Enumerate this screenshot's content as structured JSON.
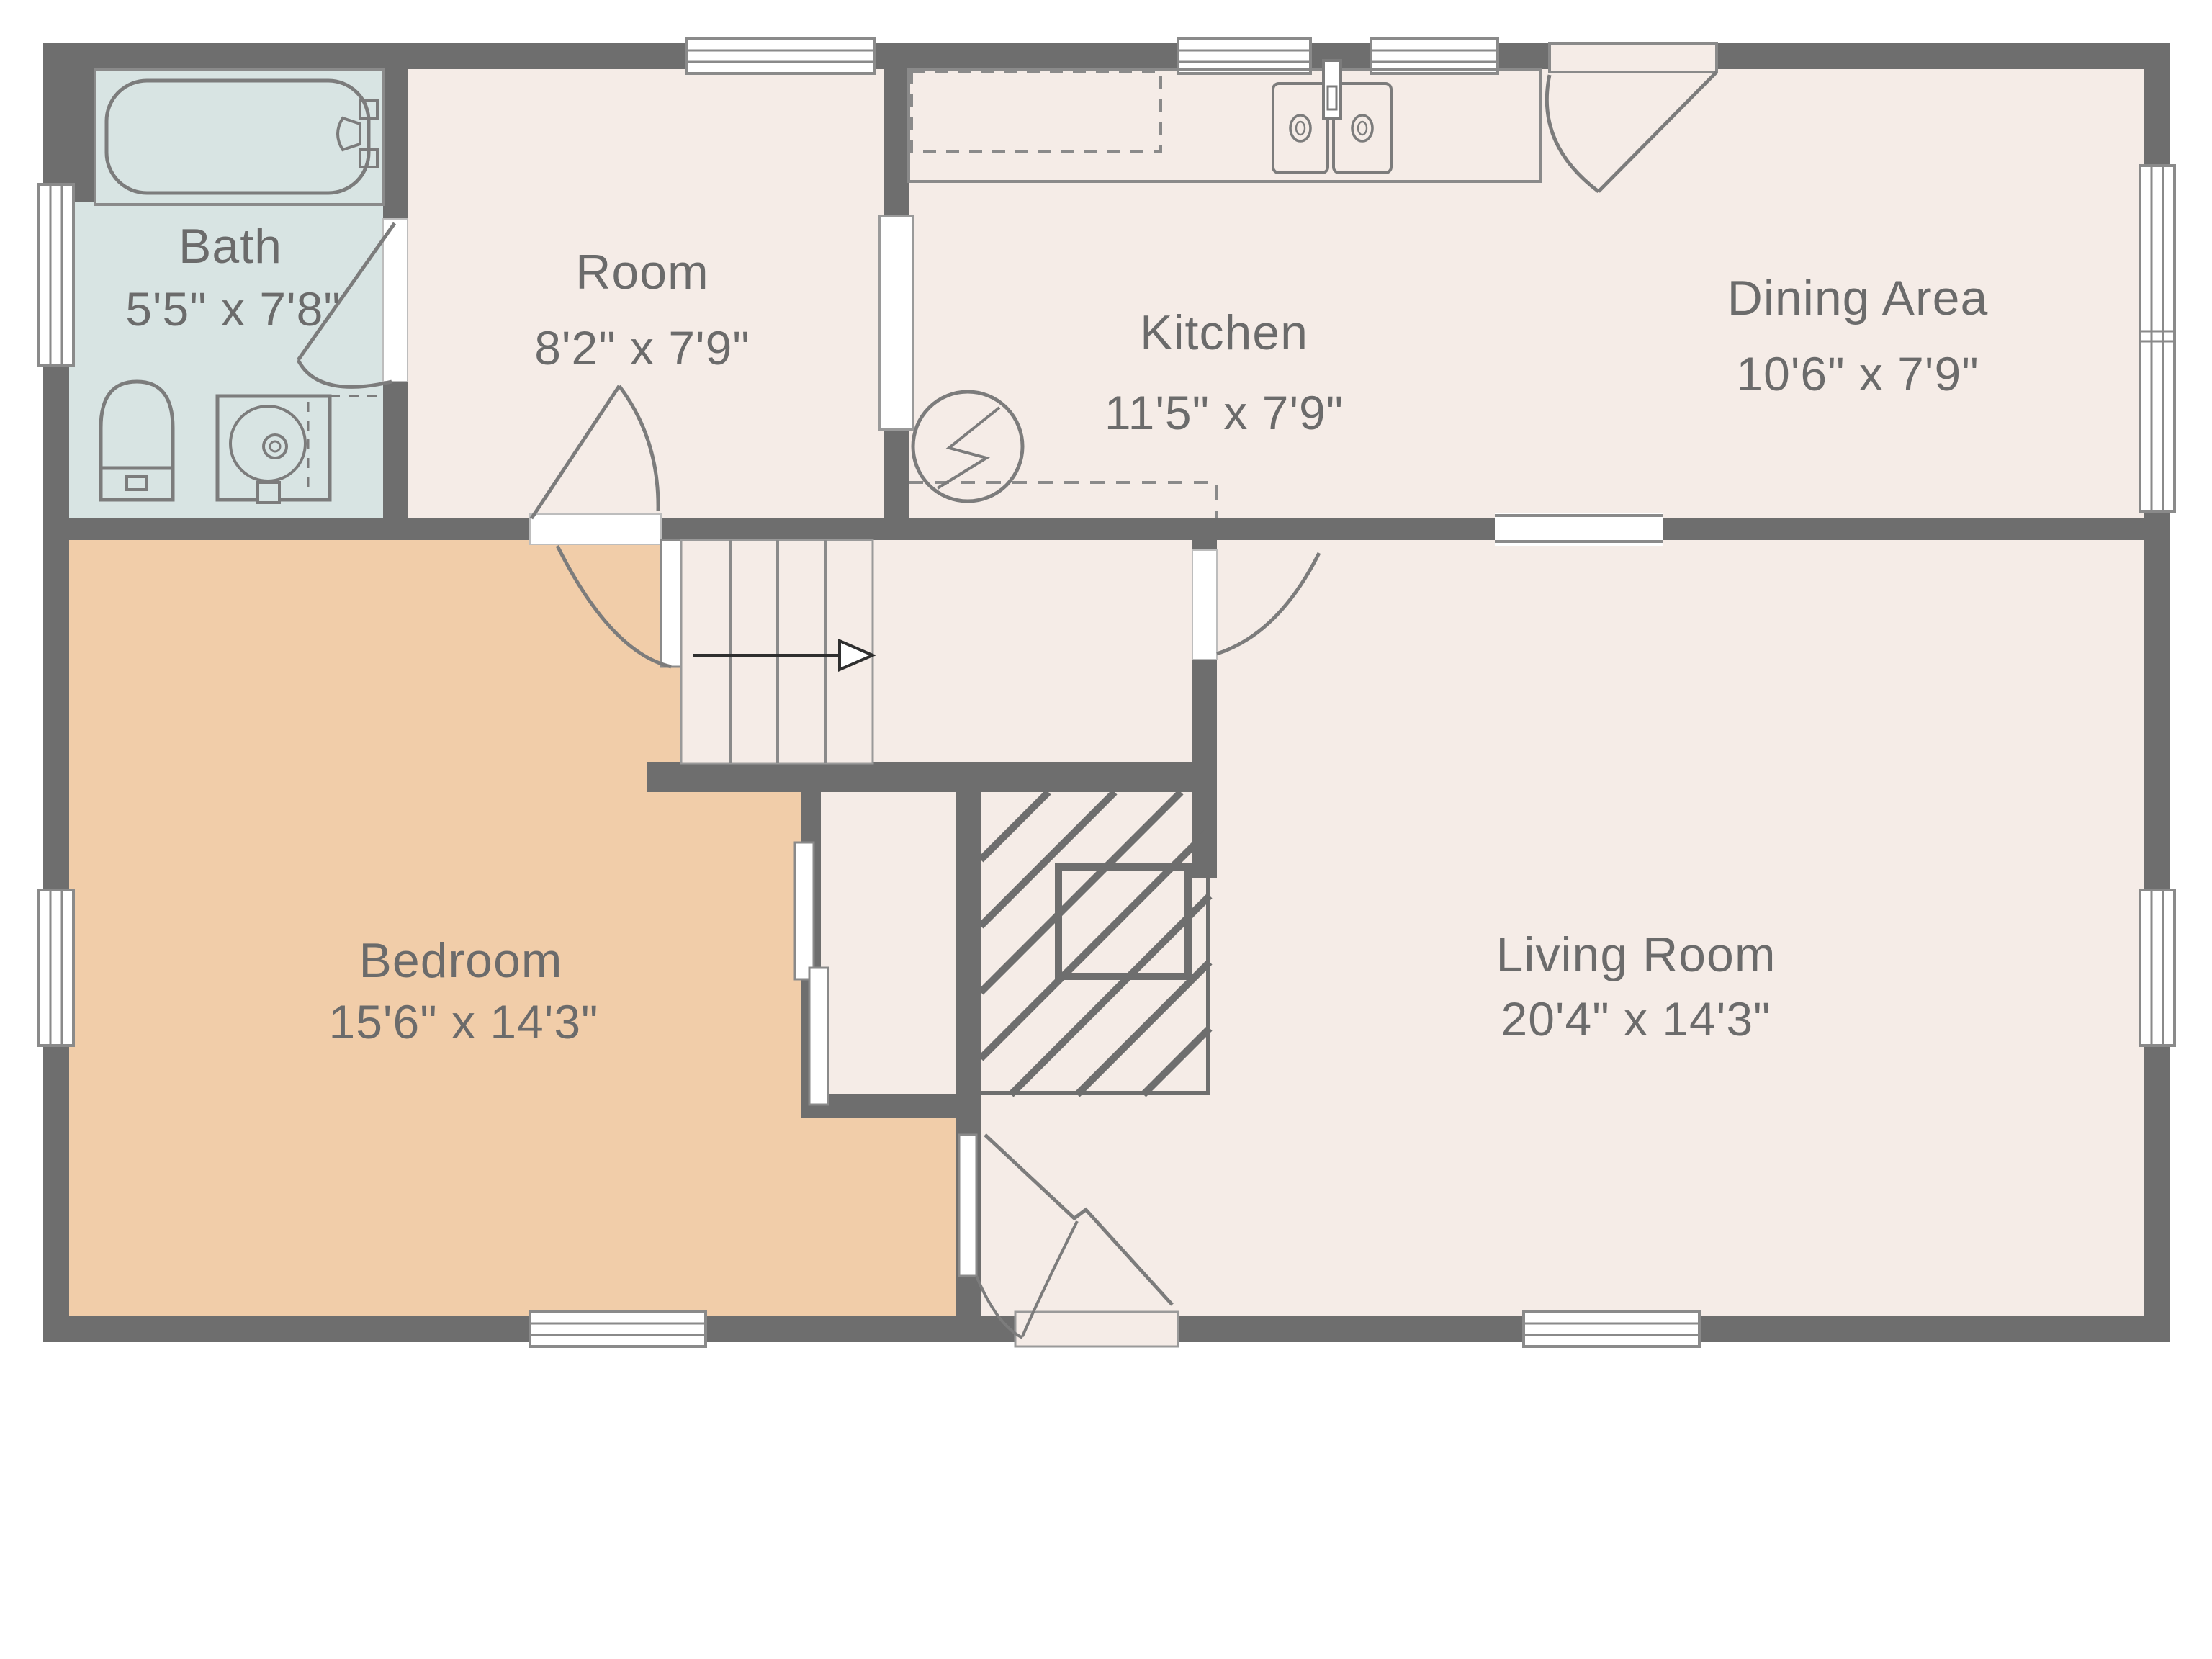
{
  "floor_plan": {
    "rooms": [
      {
        "name": "Bath",
        "dimensions": "5'5\" x 7'8\""
      },
      {
        "name": "Room",
        "dimensions": "8'2\" x 7'9\""
      },
      {
        "name": "Kitchen",
        "dimensions": "11'5\" x 7'9\""
      },
      {
        "name": "Dining Area",
        "dimensions": "10'6\" x 7'9\""
      },
      {
        "name": "Bedroom",
        "dimensions": "15'6\" x 14'3\""
      },
      {
        "name": "Living Room",
        "dimensions": "20'4\" x 14'3\""
      }
    ],
    "fixtures": [
      "bathtub",
      "toilet",
      "vanity-sink",
      "double-kitchen-sink",
      "upper-cabinets-dashed",
      "staircase-up-arrow",
      "chimney-hatch",
      "electrical-symbol",
      "closet-sliding-door"
    ],
    "colors": {
      "wall": "#6e6e6e",
      "floor": "#f5ece7",
      "bath_floor": "#d8e4e3",
      "bedroom_floor": "#f1cda9",
      "background": "#ffffff",
      "fixture_line": "#7c7c7c",
      "window_line": "#8a8a8a",
      "text": "#6b6b6b",
      "arrow": "#2f2f2f"
    }
  }
}
